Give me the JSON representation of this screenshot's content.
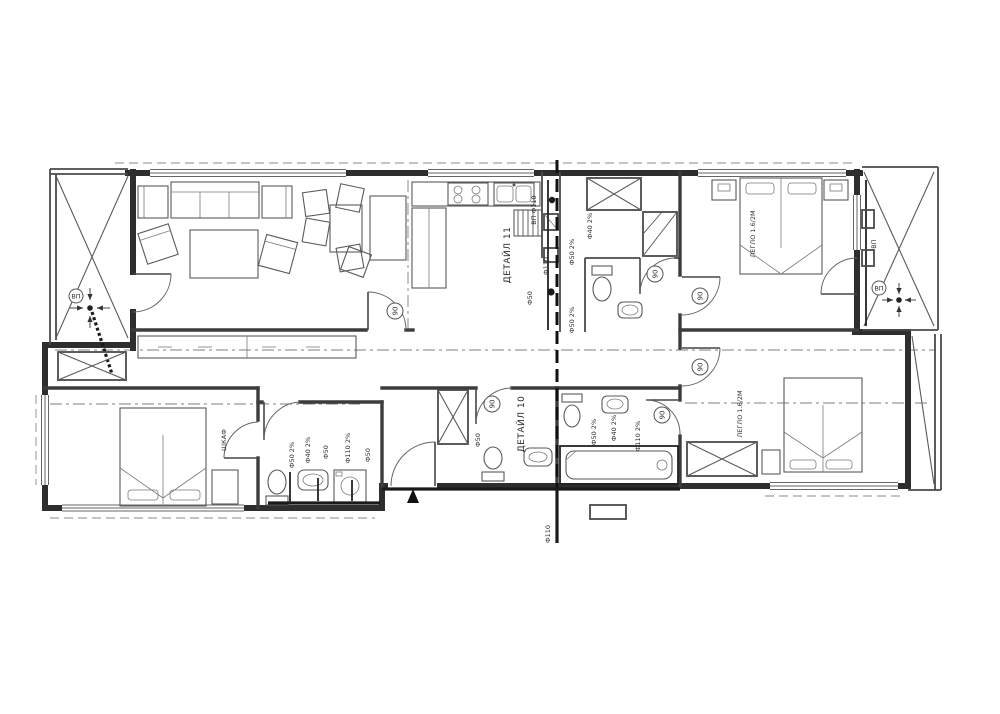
{
  "drawing": {
    "kind": "apartment floor plan – plumbing installation",
    "line_color": "#2e2e2e",
    "pipe_color": "#1a1a1a",
    "background": "#ffffff"
  },
  "labels": {
    "detail_11": "ДЕТАЙЛ 11",
    "detail_10": "ДЕТАЙЛ 10",
    "door_width": "90",
    "bed_size": "ЛЕГЛО 1.6/2М",
    "wardrobe": "ШКАФ",
    "pipe_f50": "Ф50",
    "pipe_f50_slope": "Ф50 2%",
    "pipe_f40_slope": "Ф40 2%",
    "pipe_f110": "Ф110",
    "pipe_f110_slope": "Ф110 2%",
    "riser": "ВП",
    "riser_f110": "ВП Ф110"
  },
  "symbols": {
    "entrance_marker": "filled-triangle",
    "floor_drain": "dot-with-slope-arrows",
    "wardrobe_symbol": "crossed-box",
    "section_line": "heavy-dashed-vertical"
  }
}
